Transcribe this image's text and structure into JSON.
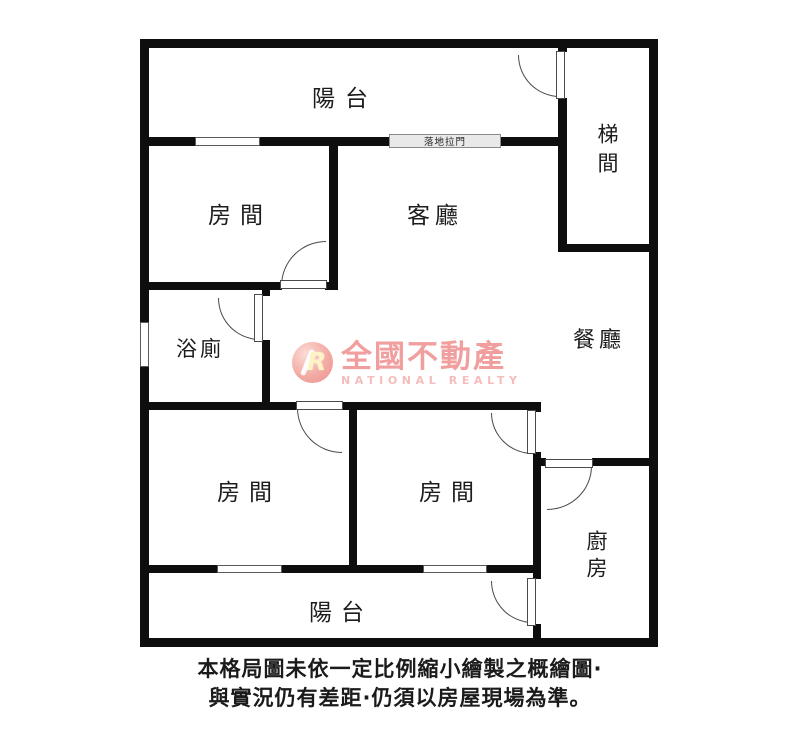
{
  "rooms": [
    {
      "id": "balcony-top",
      "label": "陽台"
    },
    {
      "id": "stairwell",
      "label": "梯間"
    },
    {
      "id": "bedroom-top-left",
      "label": "房間"
    },
    {
      "id": "living-room",
      "label": "客廳"
    },
    {
      "id": "bathroom",
      "label": "浴廁"
    },
    {
      "id": "dining-room",
      "label": "餐廳"
    },
    {
      "id": "bedroom-bottom-left",
      "label": "房間"
    },
    {
      "id": "bedroom-bottom-middle",
      "label": "房間"
    },
    {
      "id": "kitchen",
      "label": "廚房"
    },
    {
      "id": "balcony-bottom",
      "label": "陽台"
    }
  ],
  "annotations": {
    "sliding_door_label": "落地拉門"
  },
  "watermark": {
    "logo_letter": "R",
    "brand_cjk": "全國不動產",
    "brand_en": "NATIONAL REALTY",
    "accent_color": "#f19e9e"
  },
  "disclaimer": {
    "line1": "本格局圖未依一定比例縮小繪製之概繪圖·",
    "line2": "與實況仍有差距·仍須以房屋現場為準。"
  }
}
